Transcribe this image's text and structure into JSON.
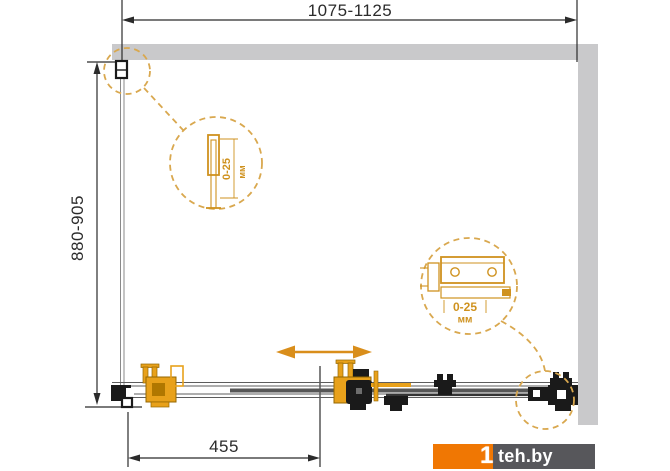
{
  "diagram": {
    "type": "shower-enclosure-dimension-drawing",
    "dims": {
      "width_range": "1075-1125",
      "height_range": "880-905",
      "door_width": "455"
    },
    "details": {
      "left": {
        "range": "0-25",
        "unit": "мм"
      },
      "right": {
        "range": "0-25",
        "unit": "мм"
      }
    },
    "logo": {
      "one": "1",
      "site": "teh.by"
    },
    "colors": {
      "wall_gray": "#c9c9cb",
      "hardware_orange": "#e8a11b",
      "dashed_orange": "#d9a84f",
      "arrow_orange": "#d98e1b",
      "logo_orange": "#f07703",
      "logo_gray": "#57575b",
      "line_black": "#1a1a1a"
    }
  }
}
